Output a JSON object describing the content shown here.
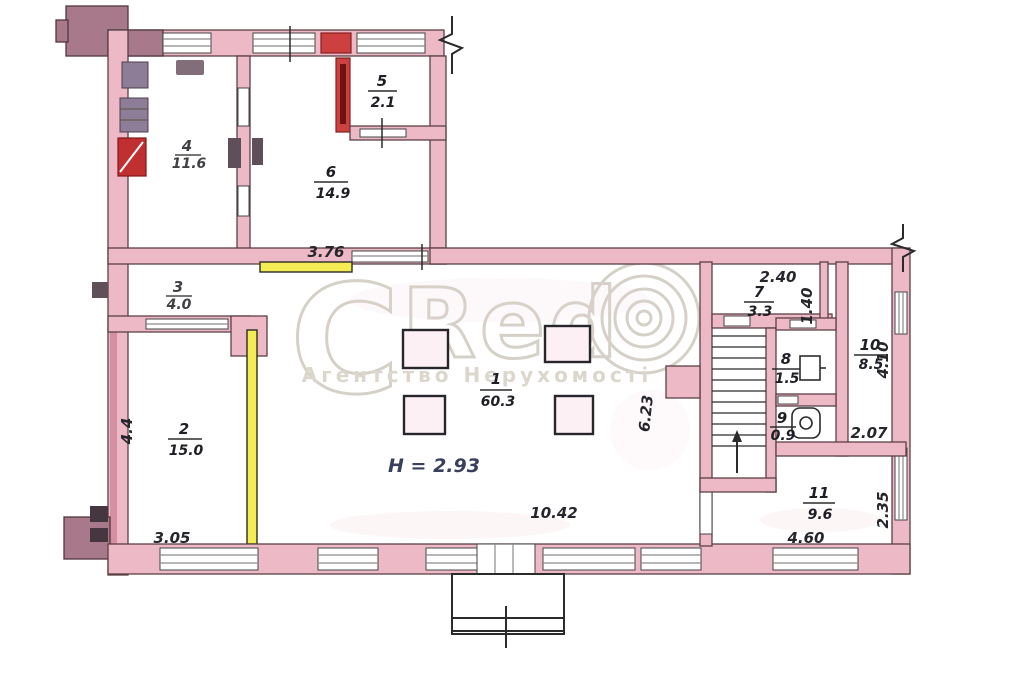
{
  "plan": {
    "rooms": [
      {
        "number": "1",
        "area": "60.3"
      },
      {
        "number": "2",
        "area": "15.0"
      },
      {
        "number": "3",
        "area": "4.0"
      },
      {
        "number": "4",
        "area": "11.6"
      },
      {
        "number": "5",
        "area": "2.1"
      },
      {
        "number": "6",
        "area": "14.9"
      },
      {
        "number": "7",
        "area": "3.3"
      },
      {
        "number": "8",
        "area": "1.5"
      },
      {
        "number": "9",
        "area": "0.9"
      },
      {
        "number": "10",
        "area": "8.5"
      },
      {
        "number": "11",
        "area": "9.6"
      }
    ],
    "ceiling_height": "H = 2.93",
    "dimensions": {
      "wing_wall": "3.76",
      "room7_width": "2.40",
      "niche_height": "1.40",
      "room10_height": "4.10",
      "room10_width": "2.07",
      "corridor_height": "6.23",
      "room11_height": "2.35",
      "hall_width": "10.42",
      "room11_width": "4.60",
      "room2_width": "3.05",
      "left_wall": "4.4"
    }
  },
  "watermark": {
    "letter_c": "C",
    "letters_red": "Red",
    "subtitle": "Агентство Нерухомості"
  },
  "colors": {
    "wall_pink": "#edb9c6",
    "wall_dark": "#a8798a",
    "highlight_red": "#cc4040",
    "highlight_yellow": "#f3ec52",
    "watermark_gray": "#d5d1c8",
    "ink": "#2b2b2b"
  }
}
